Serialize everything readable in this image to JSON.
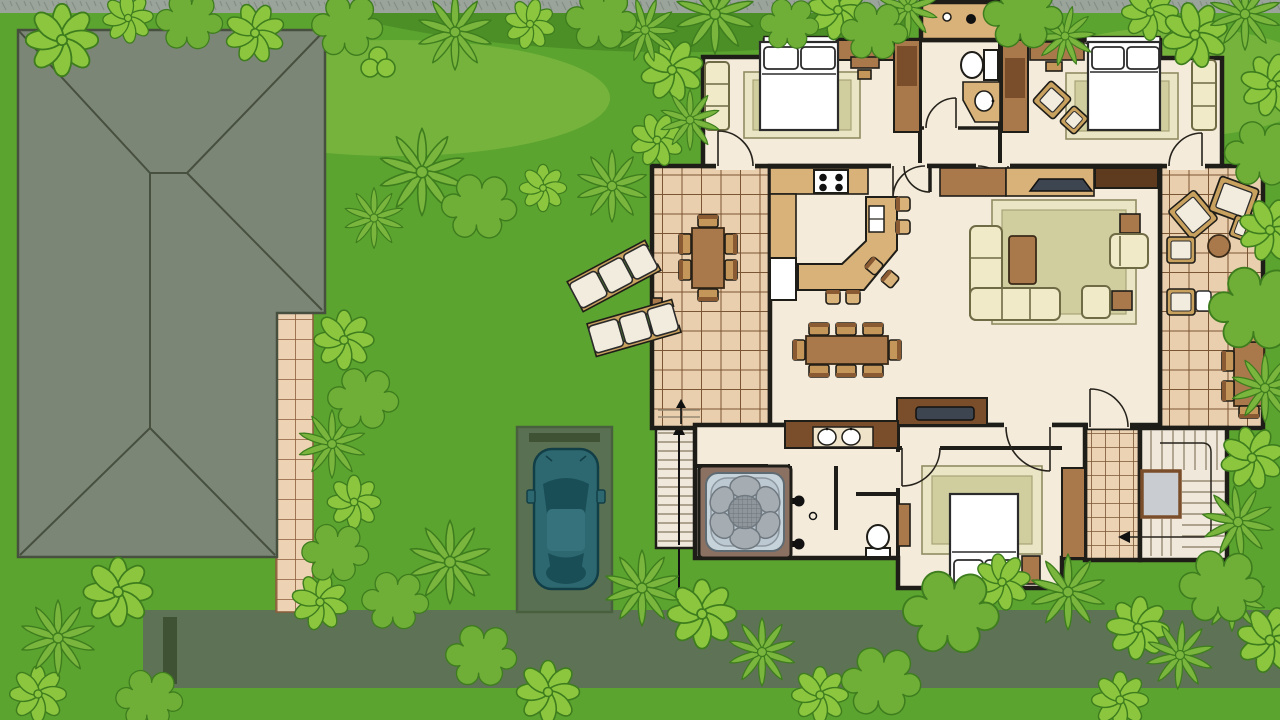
{
  "title": "Aerial site plan: house floor plan with furniture, neighbouring hipped roof, driveway with parked car, garden with bushes, sun loungers and hot tub",
  "palette": {
    "lawn": "#5BA42F",
    "lawnLight": "#76B33C",
    "lawnDark": "#4C8F27",
    "gravel": "#9BA49B",
    "gravelLine": "#848E85",
    "road": "#5E7355",
    "roadMark": "#3F5233",
    "drivePad": "#5A7052",
    "padLine": "#48603E",
    "pathTile": "#EDD2B3",
    "pathGrout": "#8A5D3B",
    "roof": "#7C8677",
    "roofLine": "#474F3E",
    "bushLight": "#8CC63F",
    "bushMid": "#6FAE37",
    "bushPalm": "#7AB63D",
    "bushOutline": "#3E7D1E",
    "wall": "#1F1D18",
    "floor": "#F4EBDA",
    "deckTile": "#E9CFAD",
    "deckGrout": "#7A5634",
    "furnTan": "#D9B279",
    "furnBrown": "#A9794C",
    "furnBrownDark": "#7A4E2A",
    "furnDarkWood": "#5E3A1F",
    "cream": "#F1EAC9",
    "creamLine": "#6F6B45",
    "rug": "#D0CE9F",
    "rugBorder": "#EAE5C5",
    "white": "#FFFFFF",
    "tread": "#F0E8DA",
    "treadLine": "#958A74",
    "landing": "#C9CDD1",
    "carBody": "#2D6870",
    "carRoof": "#35727B",
    "carGlass": "#1A4E57",
    "carLine": "#123F47",
    "tubFrame": "#8B7162",
    "tubWater": "#C7D3DB",
    "tubSeat": "#A6ADB2",
    "tubCenter": "#8F979C",
    "tubLine": "#707980",
    "tv": "#3C4550",
    "chairTan": "#C49659",
    "woodLight": "#C9A15F"
  },
  "scene": {
    "site_elements": [
      "lawn",
      "gravel-strip",
      "road",
      "road-marker-post",
      "driveway-pad",
      "stone-path",
      "neighbor-hipped-roof",
      "garden-bushes",
      "two-sun-loungers",
      "parked-car",
      "exterior-stairs",
      "direction-arrow"
    ],
    "house_rooms": [
      {
        "name": "bedroom-1",
        "items": [
          "double-bed",
          "two-pillows",
          "rug",
          "settee",
          "desk-with-chair",
          "wardrobes",
          "door"
        ]
      },
      {
        "name": "bathroom-1",
        "items": [
          "toilet",
          "vanity-with-sink",
          "door"
        ]
      },
      {
        "name": "utility-closet",
        "items": [
          "two-fixtures"
        ]
      },
      {
        "name": "bedroom-2",
        "items": [
          "double-bed",
          "two-pillows",
          "rug",
          "rotated-armchair",
          "footstool",
          "settee",
          "desk",
          "wardrobe",
          "door"
        ]
      },
      {
        "name": "kitchen",
        "items": [
          "l-shaped-counter",
          "cooktop-four-burners",
          "fridge",
          "curved-island-bar",
          "island-sink",
          "six-bar-stools",
          "door"
        ]
      },
      {
        "name": "dining-area",
        "items": [
          "table",
          "eight-chairs"
        ]
      },
      {
        "name": "living-room",
        "items": [
          "tv-console",
          "tv",
          "media-cabinet",
          "corner-sofa",
          "rug",
          "coffee-table",
          "armchair",
          "ottoman",
          "two-side-tables",
          "sideboard-with-tray"
        ]
      },
      {
        "name": "left-deck",
        "items": [
          "outdoor-dining-table",
          "six-chairs",
          "bench",
          "entry-steps-with-arrow"
        ]
      },
      {
        "name": "right-deck",
        "items": [
          "two-lounge-chairs",
          "seat-pad",
          "round-table",
          "two-cushioned-chairs",
          "side-table",
          "outdoor-table",
          "four-chairs"
        ]
      },
      {
        "name": "bathroom-2",
        "items": [
          "double-vanity",
          "two-sinks",
          "shower-two-heads",
          "floor-drain",
          "toilet"
        ]
      },
      {
        "name": "hot-tub-room",
        "items": [
          "hot-tub-with-six-seats"
        ]
      },
      {
        "name": "bedroom-3",
        "items": [
          "double-bed",
          "two-pillows",
          "rug",
          "nightstand",
          "dresser",
          "wardrobe",
          "door"
        ]
      },
      {
        "name": "staircase",
        "items": [
          "u-shaped-stairs",
          "grey-landing",
          "guide-arrow"
        ]
      }
    ],
    "counts": {
      "bedrooms": 3,
      "bathrooms": 2,
      "decks": 2,
      "cars": 1,
      "sun_loungers": 2,
      "hot_tubs": 1
    }
  }
}
